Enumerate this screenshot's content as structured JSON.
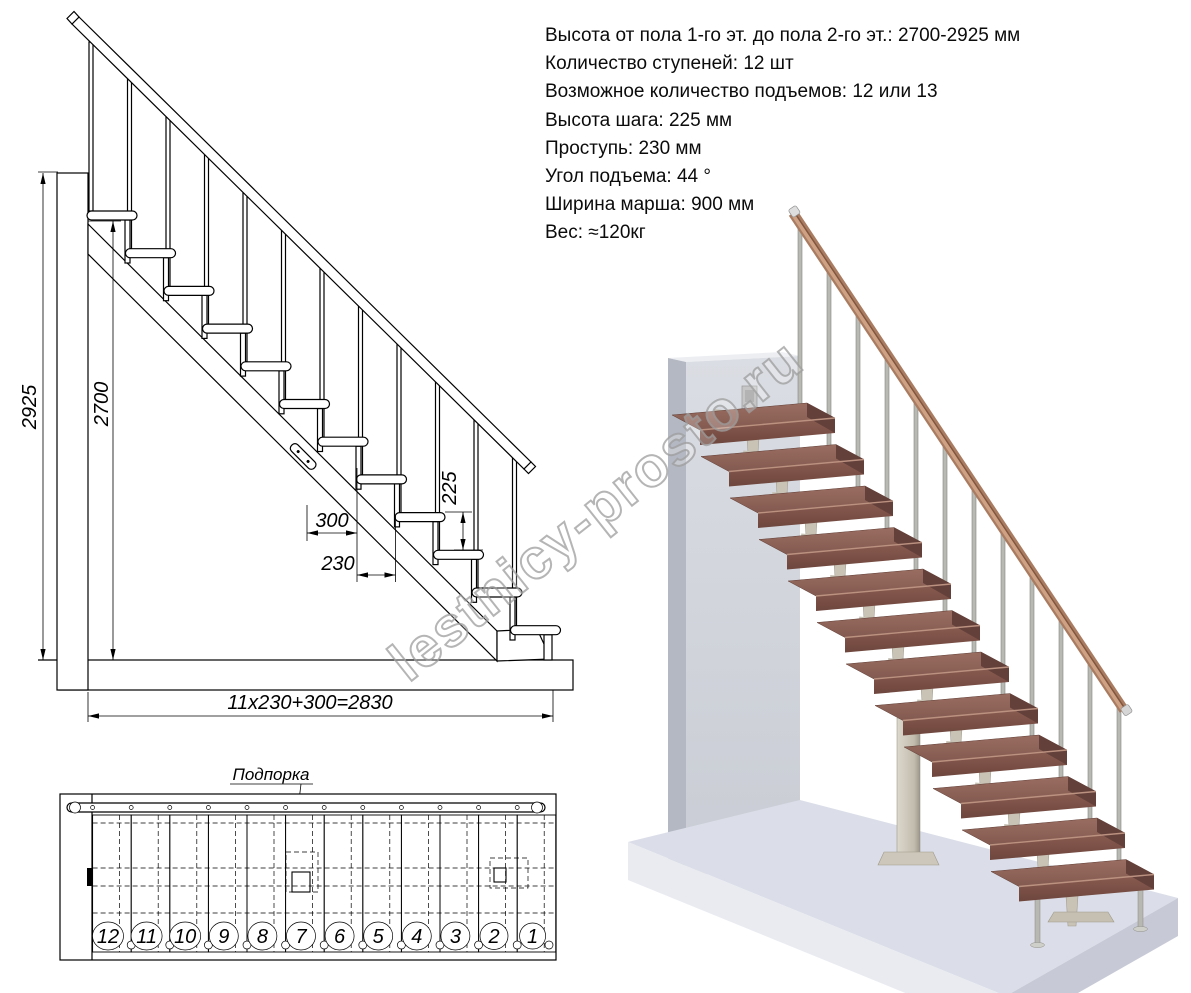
{
  "specs": {
    "lines": [
      "Высота от пола 1-го эт. до пола 2-го эт.: 2700-2925 мм",
      "Количество ступеней: 12 шт",
      "Возможное количество подъемов: 12 или 13",
      "Высота шага: 225 мм",
      "Проступь: 230 мм",
      "Угол подъема: 44 °",
      "Ширина марша: 900 мм",
      "Вес: ≈120кг"
    ]
  },
  "watermark": {
    "text": "lestnicy-prosto.ru"
  },
  "elevation": {
    "dims": {
      "total_height": "2925",
      "floor_height": "2700",
      "step_height": "225",
      "tread_depth": "300",
      "tread_run": "230",
      "total_run": "11x230+300=2830"
    }
  },
  "plan": {
    "support_label": "Подпорка",
    "step_numbers": [
      "12",
      "11",
      "10",
      "9",
      "8",
      "7",
      "6",
      "5",
      "4",
      "3",
      "2",
      "1"
    ]
  },
  "colors": {
    "tread_brown": "#8d6156",
    "tread_front": "#7a4f45",
    "rail_brown": "#a97c61",
    "metal_gray": "#b9b9b3",
    "support_beige": "#cdc7ba",
    "wall_gray": "#d3d6dd",
    "floor_gray": "#dcdfe9",
    "line_black": "#000000",
    "watermark_gray": "#9e9e9e"
  }
}
